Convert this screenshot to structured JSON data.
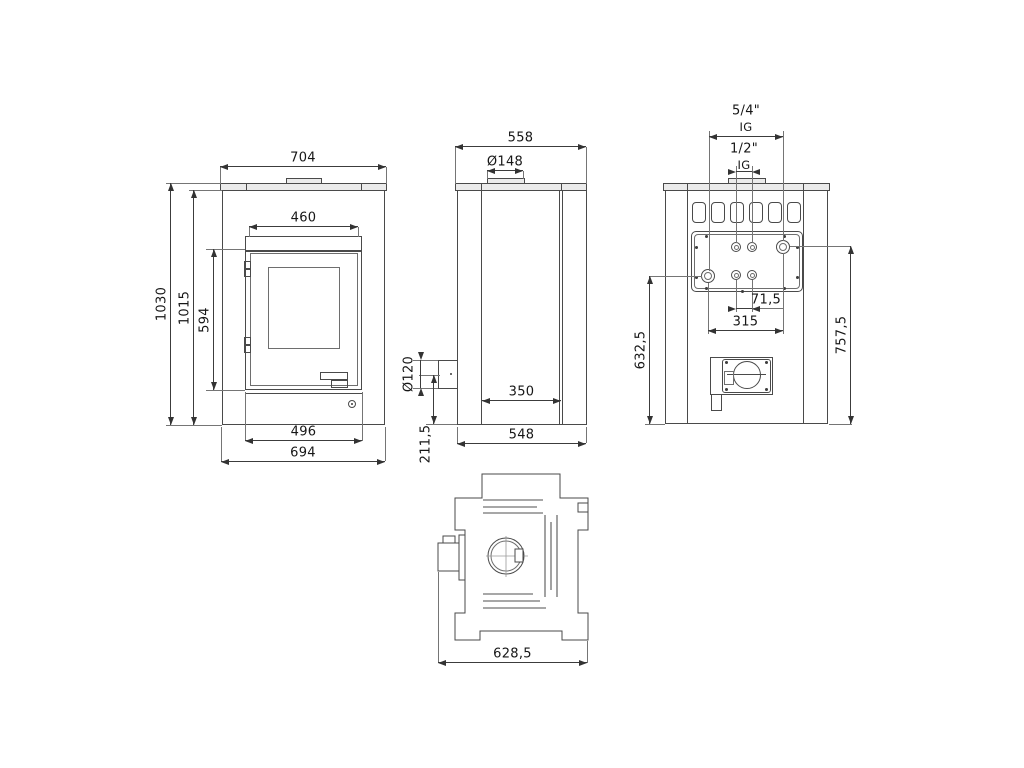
{
  "labels": {
    "d704": "704",
    "d460": "460",
    "d1030": "1030",
    "d1015": "1015",
    "d594": "594",
    "d496": "496",
    "d694": "694",
    "d558": "558",
    "dO148": "Ø148",
    "d350": "350",
    "d548": "548",
    "dO120": "Ø120",
    "d211_5": "211,5",
    "d54": "5/4\"",
    "d54_sub": "IG",
    "d12": "1/2\"",
    "d12_sub": "IG",
    "d71_5": "71,5",
    "d315": "315",
    "d757_5": "757,5",
    "d632_5": "632,5",
    "d628_5": "628,5"
  }
}
